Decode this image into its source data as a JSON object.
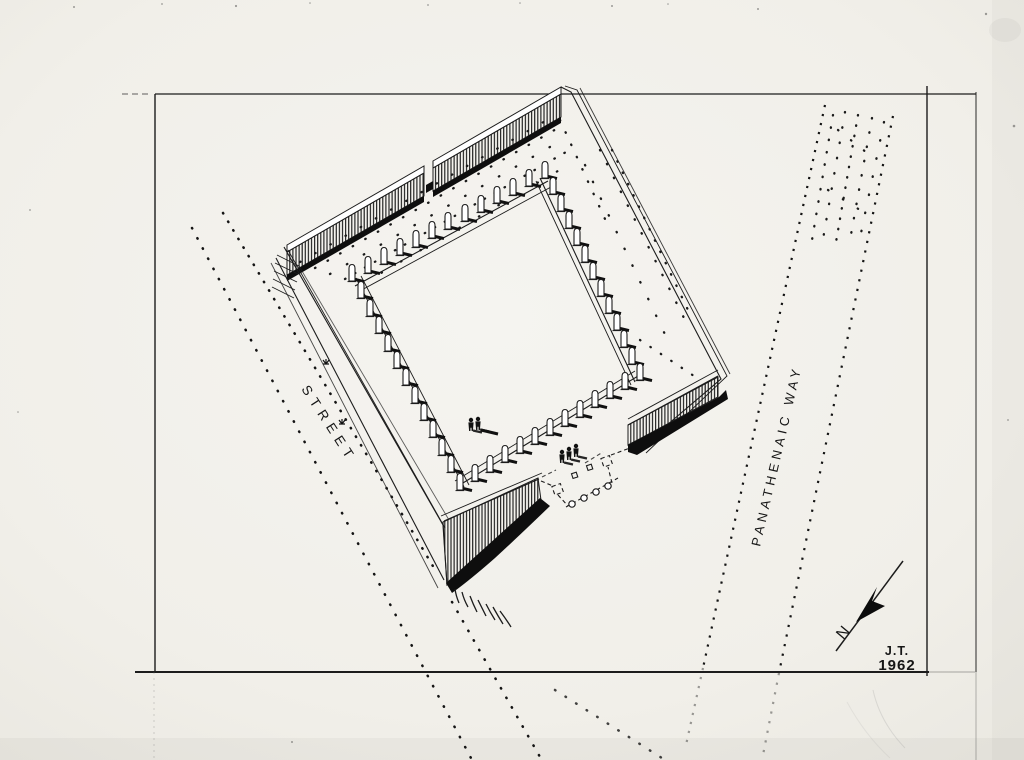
{
  "labels": {
    "street": "STREET",
    "panathenaic_way": "PANATHENAIC WAY"
  },
  "north_arrow": {
    "letter": "N"
  },
  "signature": {
    "initials": "J.T.",
    "year": "1962"
  },
  "colors": {
    "ink": "#1c1c1c",
    "paper": "#f1efe9"
  }
}
